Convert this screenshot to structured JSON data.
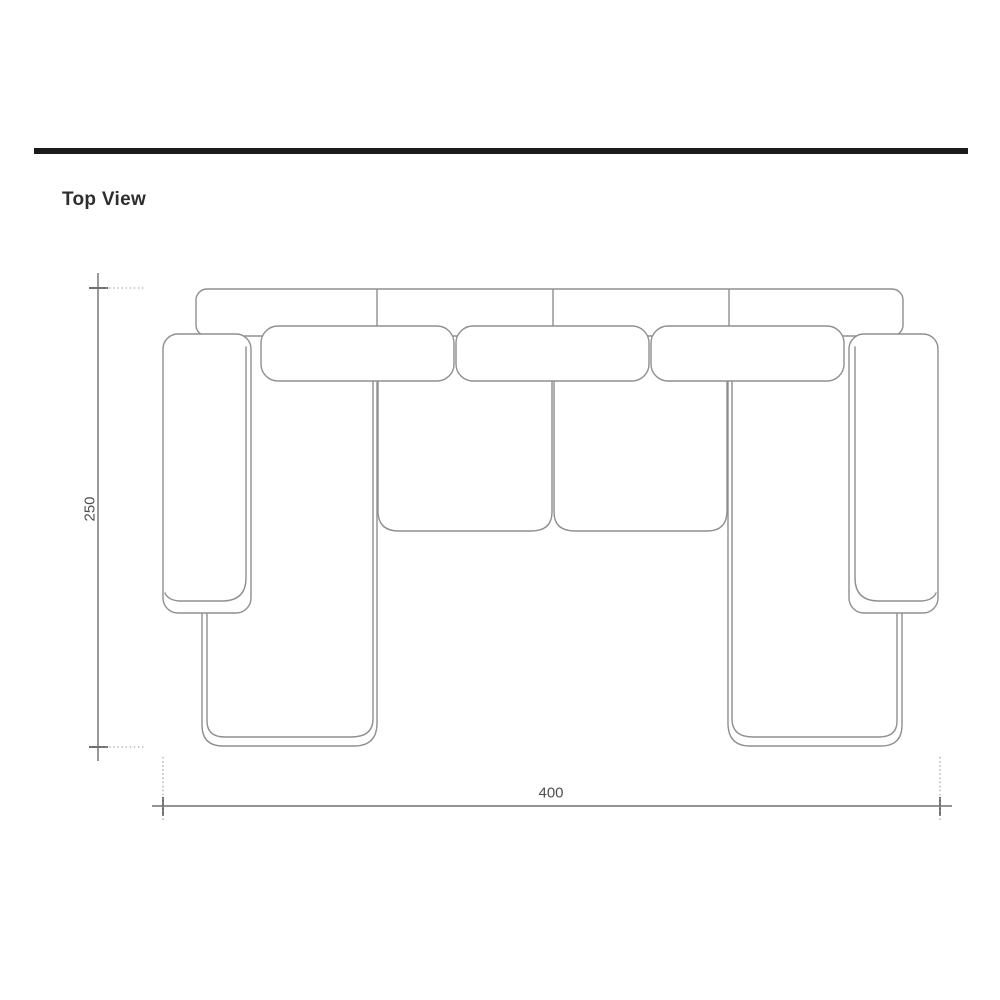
{
  "page": {
    "title": "Top View"
  },
  "drawing": {
    "subject": "u-shaped-sectional-sofa-top-view-technical-drawing"
  },
  "dimensions": {
    "height": "250",
    "width": "400"
  },
  "colors": {
    "header_bar": "#1a1a1a",
    "sketch_line": "#8f8f8f",
    "dimension_line": "#6e6e6e",
    "label_text": "#4f4f4f",
    "title_text": "#2e2e2e",
    "background": "#ffffff"
  }
}
